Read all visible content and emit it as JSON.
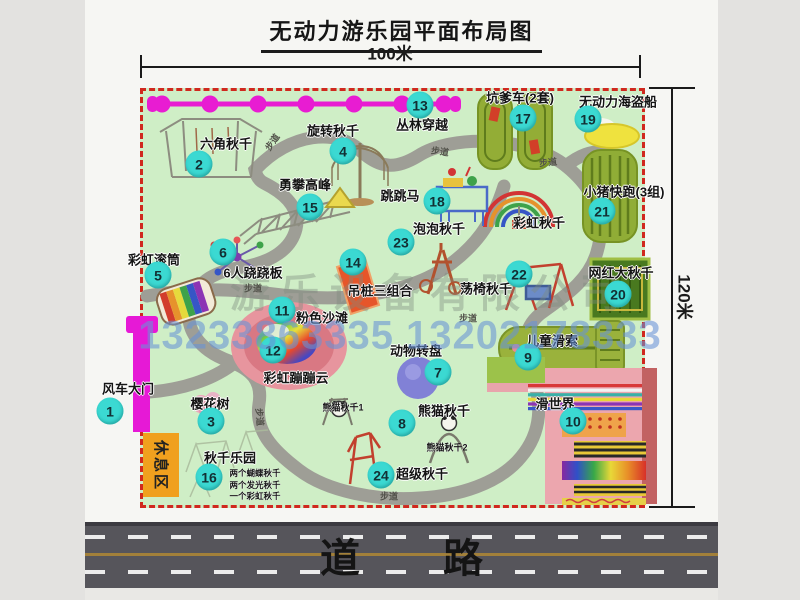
{
  "header": {
    "title": "无动力游乐园平面布局图"
  },
  "scale": {
    "width_label": "100米",
    "height_label": "120米"
  },
  "park": {
    "items": [
      {
        "num": "1",
        "label": "风车大门"
      },
      {
        "num": "2",
        "label": "六角秋千"
      },
      {
        "num": "3",
        "label": "樱花树"
      },
      {
        "num": "4",
        "label": "旋转秋千"
      },
      {
        "num": "5",
        "label": "彩虹滚筒"
      },
      {
        "num": "6",
        "label": "6人跷跷板"
      },
      {
        "num": "7",
        "label": "动物转盘"
      },
      {
        "num": "8",
        "label": "熊猫秋千"
      },
      {
        "num": "9",
        "label": "儿童滑索"
      },
      {
        "num": "10",
        "label": "滑世界"
      },
      {
        "num": "11",
        "label": "粉色沙滩"
      },
      {
        "num": "12",
        "label": "彩虹蹦蹦云"
      },
      {
        "num": "13",
        "label": "丛林穿越"
      },
      {
        "num": "14",
        "label": "吊桩三组合"
      },
      {
        "num": "15",
        "label": "勇攀高峰"
      },
      {
        "num": "16",
        "label": "秋千乐园"
      },
      {
        "num": "17",
        "label": "坑爹车(2套)"
      },
      {
        "num": "18",
        "label": "跳跳马"
      },
      {
        "num": "19",
        "label": "无动力海盗船"
      },
      {
        "num": "20",
        "label": "网红大秋千"
      },
      {
        "num": "21",
        "label": "小猪快跑(3组)"
      },
      {
        "num": "22",
        "label": "荡椅秋千"
      },
      {
        "num": "23",
        "label": "泡泡秋千"
      },
      {
        "num": "24",
        "label": "超级秋千"
      },
      {
        "num": "",
        "label": "彩虹秋千"
      }
    ],
    "sublabels": {
      "panda1": "熊猫秋千1",
      "panda2": "熊猫秋千2",
      "swing_notes": [
        "两个蝴蝶秋千",
        "两个发光秋千",
        "一个彩虹秋千"
      ]
    },
    "rest_area_label": "休息区",
    "path_label": "步道"
  },
  "road": {
    "label": "道 路"
  },
  "watermark": {
    "company": "游乐设备有限公司",
    "phone": "13233863335 13202178333"
  },
  "colors": {
    "park_green": "#cfeec6",
    "border_red": "#d0281e",
    "badge_teal": "#3bd9d2",
    "gate_magenta": "#e619d6",
    "path_gray": "#9e9e96",
    "road_gray": "#56555b",
    "rest_orange": "#f0a01e",
    "watermark_blue": "#6892d6"
  },
  "icons": [
    "jungle-zipline-icon",
    "hex-swing-icon",
    "rotating-swing-icon",
    "climbing-peak-icon",
    "kengdie-track-icon",
    "pirate-ship-icon",
    "pig-run-track-icon",
    "big-swing-icon",
    "rainbow-swing-icon",
    "jump-horse-icon",
    "bubble-swing-icon",
    "swing-chair-icon",
    "hanging-pile-icon",
    "seesaw-spinner-icon",
    "rainbow-drum-icon",
    "bounce-cloud-icon",
    "animal-turntable-icon",
    "panda-swing-icon",
    "super-swing-icon",
    "swing-park-sketch",
    "cherry-tree-icon",
    "kids-zipline-icon",
    "slide-world-icon",
    "windmill-gate-icon"
  ]
}
